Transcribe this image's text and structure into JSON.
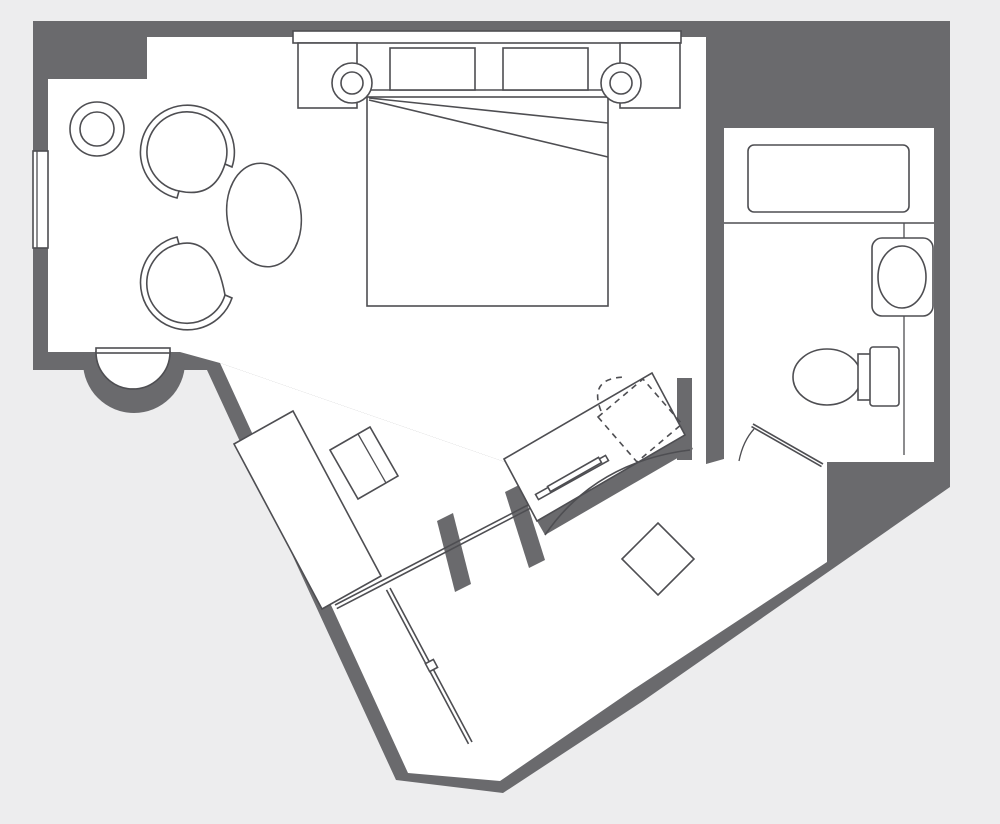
{
  "document": {
    "type": "floor-plan",
    "description": "hotel guest room floor plan, no text labels visible"
  },
  "colors": {
    "background": "#ededee",
    "wall": "#6a6a6d",
    "room": "#ffffff",
    "line": "#4e4e52"
  },
  "rooms": {
    "bedroom_sitting": {
      "fixtures": [
        "side-table",
        "tub-chair-top",
        "tub-chair-bottom",
        "oval-table",
        "window",
        "bay-niche",
        "headboard",
        "nightstand-left",
        "nightstand-right",
        "lamp-left",
        "lamp-right",
        "pillow-left",
        "pillow-right",
        "bed-mattress"
      ]
    },
    "bathroom": {
      "fixtures": [
        "bathtub",
        "vanity-counter",
        "sink",
        "toilet",
        "bathroom-door"
      ]
    },
    "entry_dressing": {
      "fixtures": [
        "wardrobe-console",
        "console-cabinet",
        "desk",
        "desk-chair-dashed",
        "desk-tray",
        "ottoman",
        "curved-closet-front",
        "sliding-door",
        "entry-door",
        "door-hinge-glyph"
      ]
    }
  }
}
